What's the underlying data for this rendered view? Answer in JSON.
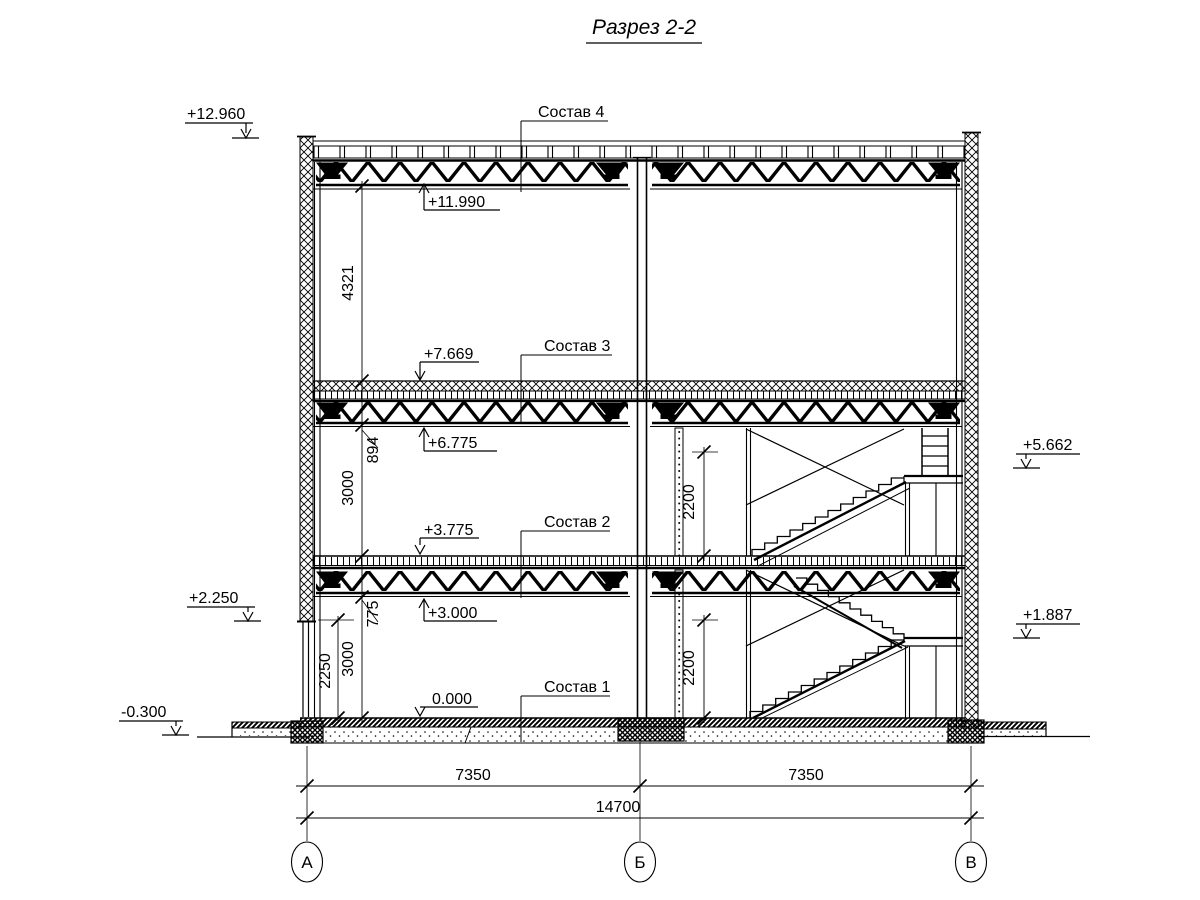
{
  "title": "Разрез 2-2",
  "elevation_marks": {
    "parapet_top": "+12.960",
    "roof_truss_bottom": "+11.990",
    "floor3_top": "+7.669",
    "floor3_truss_bottom": "+6.775",
    "floor2_top": "+3.775",
    "floor2_truss_bottom": "+3.000",
    "ground_floor": "0.000",
    "left_sill": "+2.250",
    "grade": "-0.300",
    "stair_landing_upper": "+5.662",
    "stair_landing_lower": "+1.887"
  },
  "assembly_labels": {
    "roof": "Состав 4",
    "floor3": "Состав 3",
    "floor2": "Состав 2",
    "floor1": "Состав 1"
  },
  "dimensions": {
    "attic_height": "4321",
    "floor3_structure_depth": "894",
    "story_upper_height": "3000",
    "floor2_structure_depth": "775",
    "story_lower_height": "3000",
    "left_sill_height": "2250",
    "stair_clear_upper": "2200",
    "stair_clear_lower": "2200",
    "span_left": "7350",
    "span_right": "7350",
    "span_total": "14700"
  },
  "grid_axes": {
    "a": "А",
    "b": "Б",
    "v": "В"
  },
  "line_color": "#000000"
}
